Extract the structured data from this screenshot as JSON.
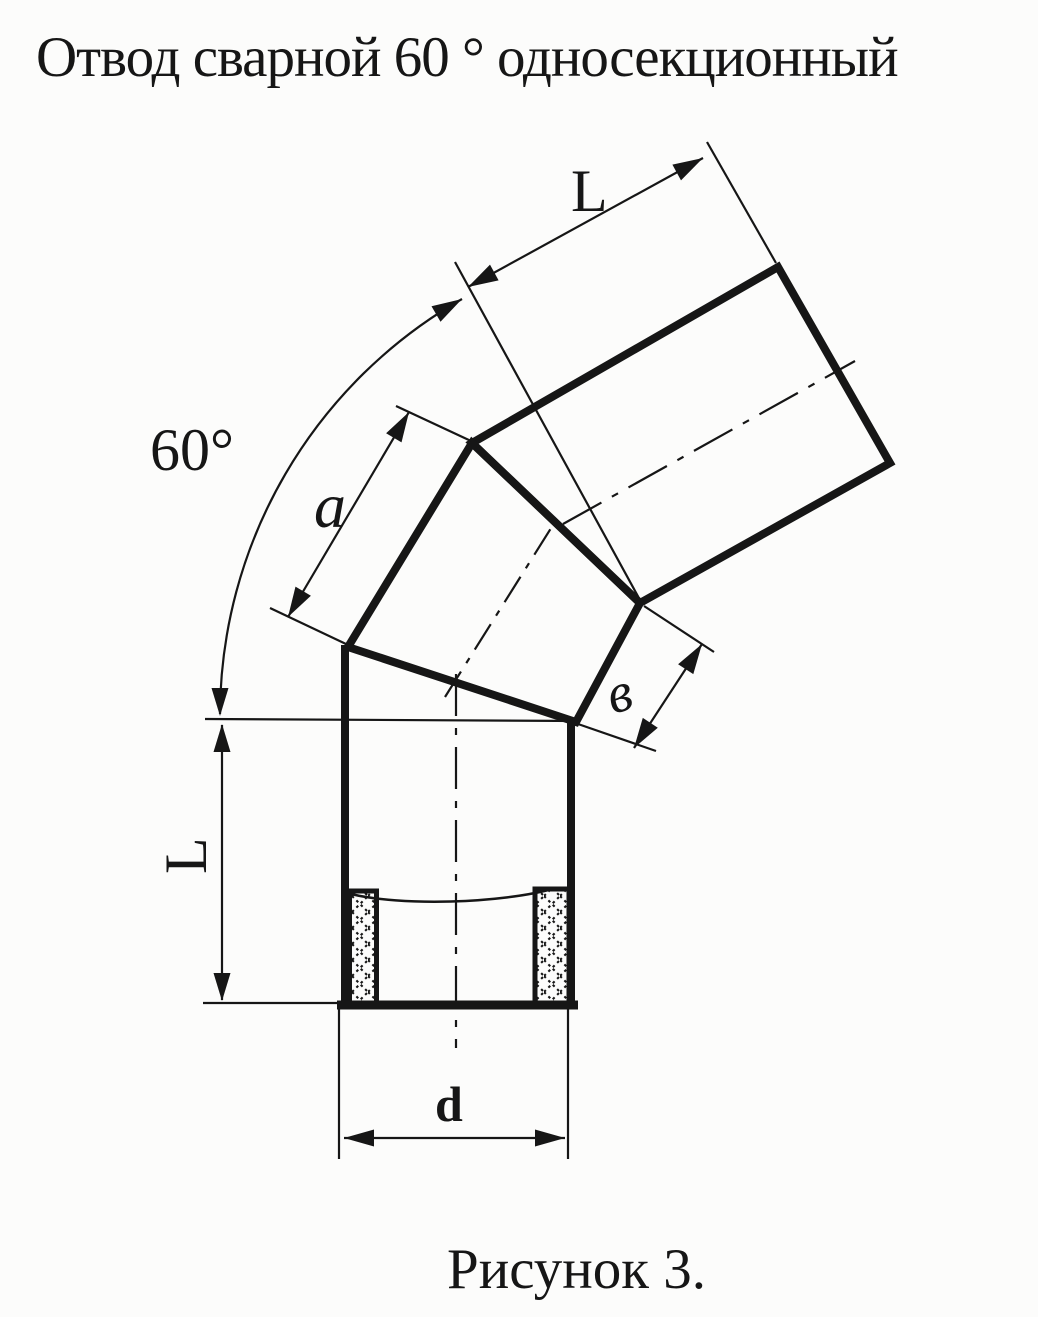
{
  "title": "Отвод сварной 60 ° односекционный",
  "caption": "Рисунок 3.",
  "labels": {
    "angle": "60°",
    "upper_length": "L",
    "lower_length": "L",
    "section_side": "a",
    "joint_width": "в",
    "diameter": "d"
  },
  "colors": {
    "ink": "#161616",
    "paper": "#fcfcfb"
  }
}
